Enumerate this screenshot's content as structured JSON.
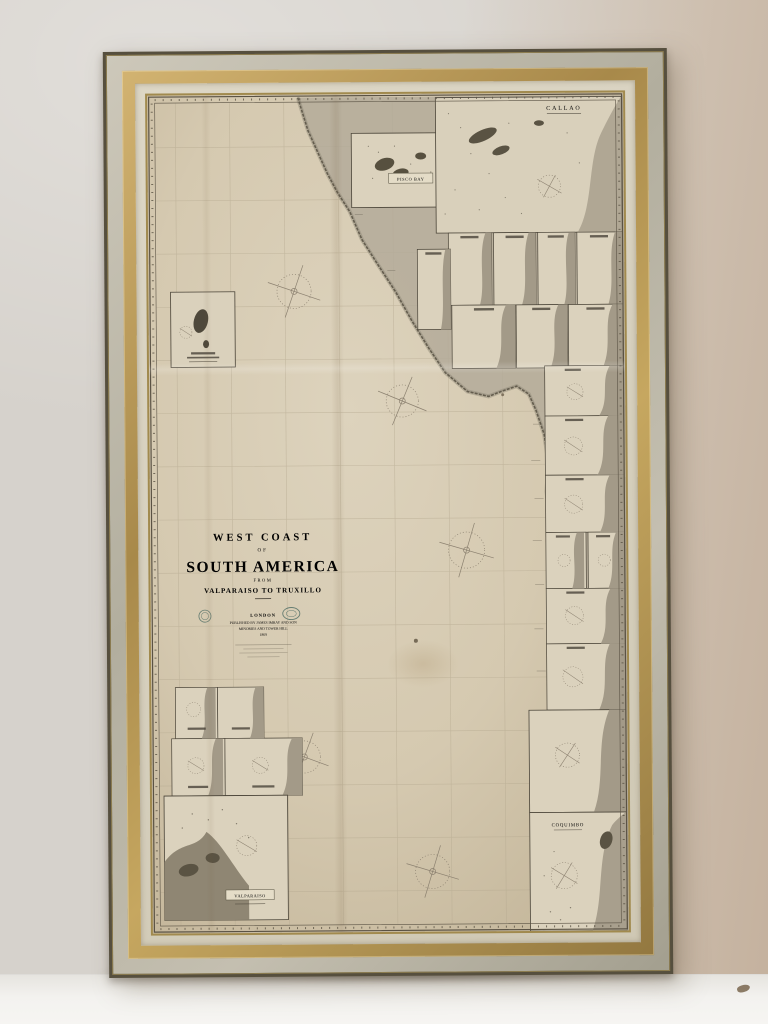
{
  "map": {
    "title_block": {
      "line1": "WEST COAST",
      "line2": "OF",
      "line3": "SOUTH AMERICA",
      "line4": "FROM",
      "line5": "VALPARAISO TO TRUXILLO",
      "imprint_line1": "LONDON",
      "imprint_line2": "PUBLISHED BY JAMES IMRAY AND SON",
      "imprint_line3": "MINORIES AND TOWER HILL",
      "imprint_line4": "1869"
    },
    "inset_labels": {
      "callao": "CALLAO",
      "pisco_bay": "PISCO BAY",
      "coquimbo": "COQUIMBO",
      "valparaiso": "VALPARAISO"
    },
    "colors": {
      "paper": "#d5c9b0",
      "land_shade": "#b2a999",
      "coast_ink": "#6c6455",
      "ink": "#38322a",
      "frame_gold": "#b79a58",
      "frame_silver": "#b8b3a4",
      "wall": "#d6d2cc",
      "floor": "#f3f2ef"
    }
  }
}
